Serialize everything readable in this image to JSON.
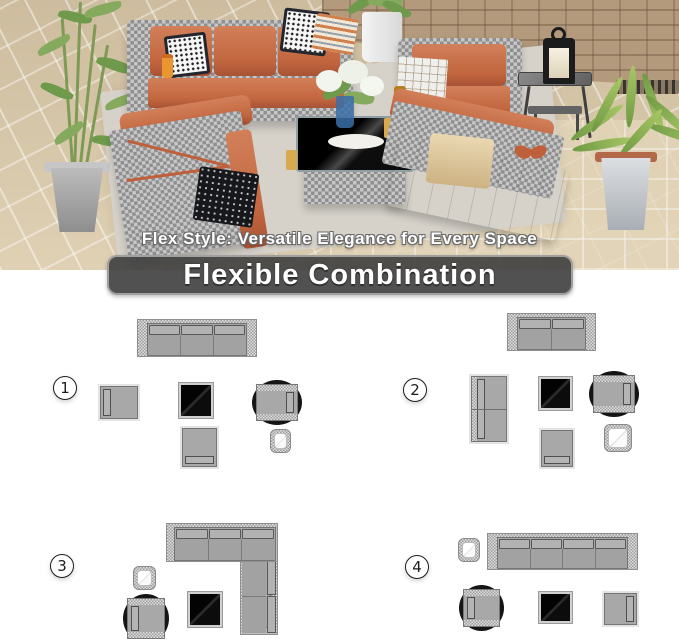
{
  "photo": {
    "caption": "Flex Style: Versatile Elegance for Every Space"
  },
  "banner": {
    "label": "Flexible Combination"
  },
  "colors": {
    "accent_orange": "#C2663F",
    "wicker_gray": "#ADADAD",
    "diagram_gray": "#A8A8A8",
    "diagram_border": "#767676",
    "glass_black": "#0B0B0B",
    "banner_bg": "#3E3E3E",
    "floor_tan": "#D8C8AC",
    "wall_stone": "#B49A7C",
    "plant_green": "#85AA5D"
  },
  "layouts": [
    {
      "number": "1",
      "items": [
        {
          "name": "three-seat-sofa",
          "type": "sofa",
          "seats": 3,
          "x": 137,
          "y": 319,
          "w": 120,
          "h": 38,
          "facing": "down"
        },
        {
          "name": "armless-sofa",
          "type": "armless",
          "x": 100,
          "y": 386,
          "w": 38,
          "h": 33,
          "facing": "right"
        },
        {
          "name": "glass-coffee-table",
          "type": "coffee",
          "x": 179,
          "y": 383,
          "w": 34,
          "h": 35
        },
        {
          "name": "swivel-chair",
          "type": "swivel",
          "x": 256,
          "y": 384,
          "w": 42,
          "h": 37,
          "facing": "left"
        },
        {
          "name": "armless-sofa",
          "type": "armless",
          "x": 182,
          "y": 428,
          "w": 35,
          "h": 39,
          "facing": "up"
        },
        {
          "name": "side-table",
          "type": "side",
          "x": 270,
          "y": 429,
          "w": 21,
          "h": 24
        }
      ]
    },
    {
      "number": "2",
      "items": [
        {
          "name": "loveseat-sofa",
          "type": "sofa",
          "seats": 2,
          "x": 507,
          "y": 313,
          "w": 89,
          "h": 38,
          "facing": "down"
        },
        {
          "name": "double-armless-sofa",
          "type": "armless2",
          "x": 471,
          "y": 376,
          "w": 36,
          "h": 66,
          "facing": "right"
        },
        {
          "name": "glass-coffee-table",
          "type": "coffee",
          "x": 539,
          "y": 377,
          "w": 33,
          "h": 33
        },
        {
          "name": "swivel-chair",
          "type": "swivel",
          "x": 593,
          "y": 375,
          "w": 42,
          "h": 38,
          "facing": "left"
        },
        {
          "name": "armless-sofa",
          "type": "armless",
          "x": 541,
          "y": 430,
          "w": 32,
          "h": 37,
          "facing": "up"
        },
        {
          "name": "side-table",
          "type": "side",
          "x": 604,
          "y": 424,
          "w": 28,
          "h": 28
        }
      ]
    },
    {
      "number": "3",
      "items": [
        {
          "name": "l-shaped-sectional",
          "type": "sectional",
          "x": 166,
          "y": 523,
          "w": 112,
          "h": 112
        },
        {
          "name": "side-table",
          "type": "side",
          "x": 133,
          "y": 566,
          "w": 23,
          "h": 24
        },
        {
          "name": "swivel-chair",
          "type": "swivel",
          "x": 127,
          "y": 598,
          "w": 38,
          "h": 41,
          "facing": "right"
        },
        {
          "name": "glass-coffee-table",
          "type": "coffee",
          "x": 188,
          "y": 592,
          "w": 34,
          "h": 35
        }
      ]
    },
    {
      "number": "4",
      "items": [
        {
          "name": "side-table",
          "type": "side",
          "x": 458,
          "y": 538,
          "w": 22,
          "h": 24
        },
        {
          "name": "four-seat-sofa",
          "type": "sofa",
          "seats": 4,
          "x": 487,
          "y": 533,
          "w": 151,
          "h": 37,
          "facing": "down"
        },
        {
          "name": "swivel-chair",
          "type": "swivel",
          "x": 463,
          "y": 589,
          "w": 37,
          "h": 38,
          "facing": "right"
        },
        {
          "name": "glass-coffee-table",
          "type": "coffee",
          "x": 539,
          "y": 592,
          "w": 33,
          "h": 31
        },
        {
          "name": "armless-sofa",
          "type": "armless",
          "x": 604,
          "y": 593,
          "w": 33,
          "h": 32,
          "facing": "left"
        }
      ]
    }
  ]
}
